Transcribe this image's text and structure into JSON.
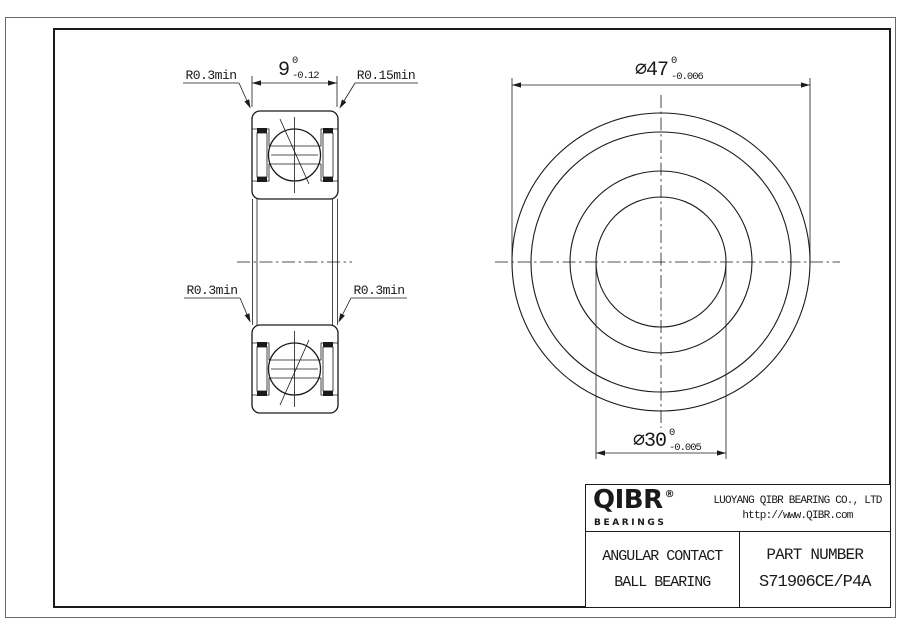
{
  "colors": {
    "line": "#1a1a1a",
    "background": "#ffffff"
  },
  "section_view": {
    "width_dim": {
      "value": "9",
      "upper_tolerance": "0",
      "lower_tolerance": "-0.12"
    },
    "chamfer_labels": {
      "top_left": "R0.3min",
      "top_right": "R0.15min",
      "bottom_left": "R0.3min",
      "bottom_right": "R0.3min"
    }
  },
  "front_view": {
    "outer_diameter_dim": {
      "value": "⌀47",
      "upper_tolerance": "0",
      "lower_tolerance": "-0.006"
    },
    "bore_diameter_dim": {
      "value": "⌀30",
      "upper_tolerance": "0",
      "lower_tolerance": "-0.005"
    }
  },
  "title_block": {
    "logo": {
      "text": "QIBR",
      "registered": "®",
      "subtext": "BEARINGS"
    },
    "company": "LUOYANG QIBR BEARING CO., LTD",
    "website": "http://www.QIBR.com",
    "product_type_line1": "ANGULAR CONTACT",
    "product_type_line2": "BALL BEARING",
    "part_number_label": "PART NUMBER",
    "part_number": "S71906CE/P4A"
  }
}
